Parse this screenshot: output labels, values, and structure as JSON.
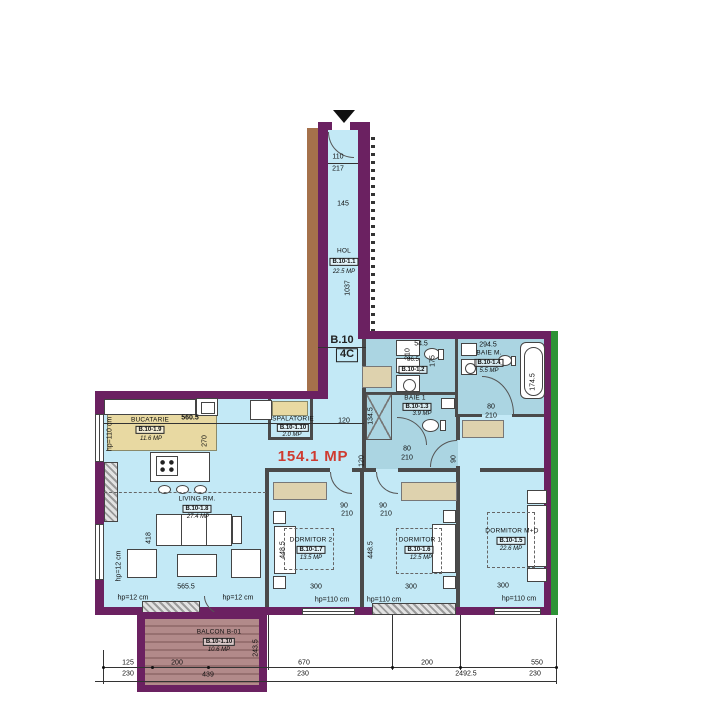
{
  "unit": {
    "block": "B.10",
    "type": "4C",
    "total_area": "154.1 MP"
  },
  "rooms": {
    "hol": {
      "name": "HOL",
      "code": "B.10-1.1",
      "area": "22.5 MP"
    },
    "wc2": {
      "code": "B.10-1.2"
    },
    "baie1": {
      "name": "BAIE 1",
      "code": "B.10-1.3",
      "area": "3.9 MP"
    },
    "baiem": {
      "name": "BAIE M.",
      "code": "B.10-1.4",
      "area": "5.5 MP"
    },
    "dormitormd": {
      "name": "DORMITOR M+D",
      "code": "B.10-1.5",
      "area": "22.6 MP"
    },
    "dormitor1": {
      "name": "DORMITOR 1",
      "code": "B.10-1.6",
      "area": "12.5 MP"
    },
    "dormitor2": {
      "name": "DORMITOR 2",
      "code": "B.10-1.7",
      "area": "13.5 MP"
    },
    "living": {
      "name": "LIVING RM.",
      "code": "B.10-1.8",
      "area": "27.4 MP"
    },
    "bucatarie": {
      "name": "BUCATARIE",
      "code": "B.10-1.9",
      "area": "11.6 MP"
    },
    "spalatorie": {
      "name": "SPALATORIE",
      "code": "B.10-1.10",
      "area": "2.0 MP"
    },
    "balcon": {
      "name": "BALCON B-01",
      "code": "B.10-1.10",
      "area": "10.6 MP"
    }
  },
  "dims": {
    "v110": "110",
    "v217": "217",
    "v145": "145",
    "v1037": "1037",
    "v560_5": "560.5",
    "v270": "270",
    "v120": "120",
    "v54_5": "54.5",
    "v86_5": "86.5",
    "v175": "175",
    "v210": "210",
    "v134_5": "134.5",
    "v294_5": "294.5",
    "v174_5": "174.5",
    "v80": "80",
    "v90": "90",
    "v418": "418",
    "v565_5": "565.5",
    "v448_5": "448.5",
    "v300": "300",
    "v243_5": "243.5",
    "hp110": "hp=110 cm",
    "hp12": "hp=12 cm",
    "row1": [
      "125",
      "200",
      "670",
      "200",
      "550"
    ],
    "row2": [
      "230",
      "439",
      "230",
      "2492.5",
      "230"
    ]
  },
  "colors": {
    "wall": "#6b2161",
    "exterior_brown": "#a5714b",
    "exterior_green": "#2e9336",
    "floor": "#c3e9f6",
    "bath_floor": "#abd5e2",
    "kitchen_zone": "#e8d9a2",
    "furniture": "#ded2ae",
    "balcony": "#b28a8a",
    "total_area_red": "#cf3b30"
  }
}
